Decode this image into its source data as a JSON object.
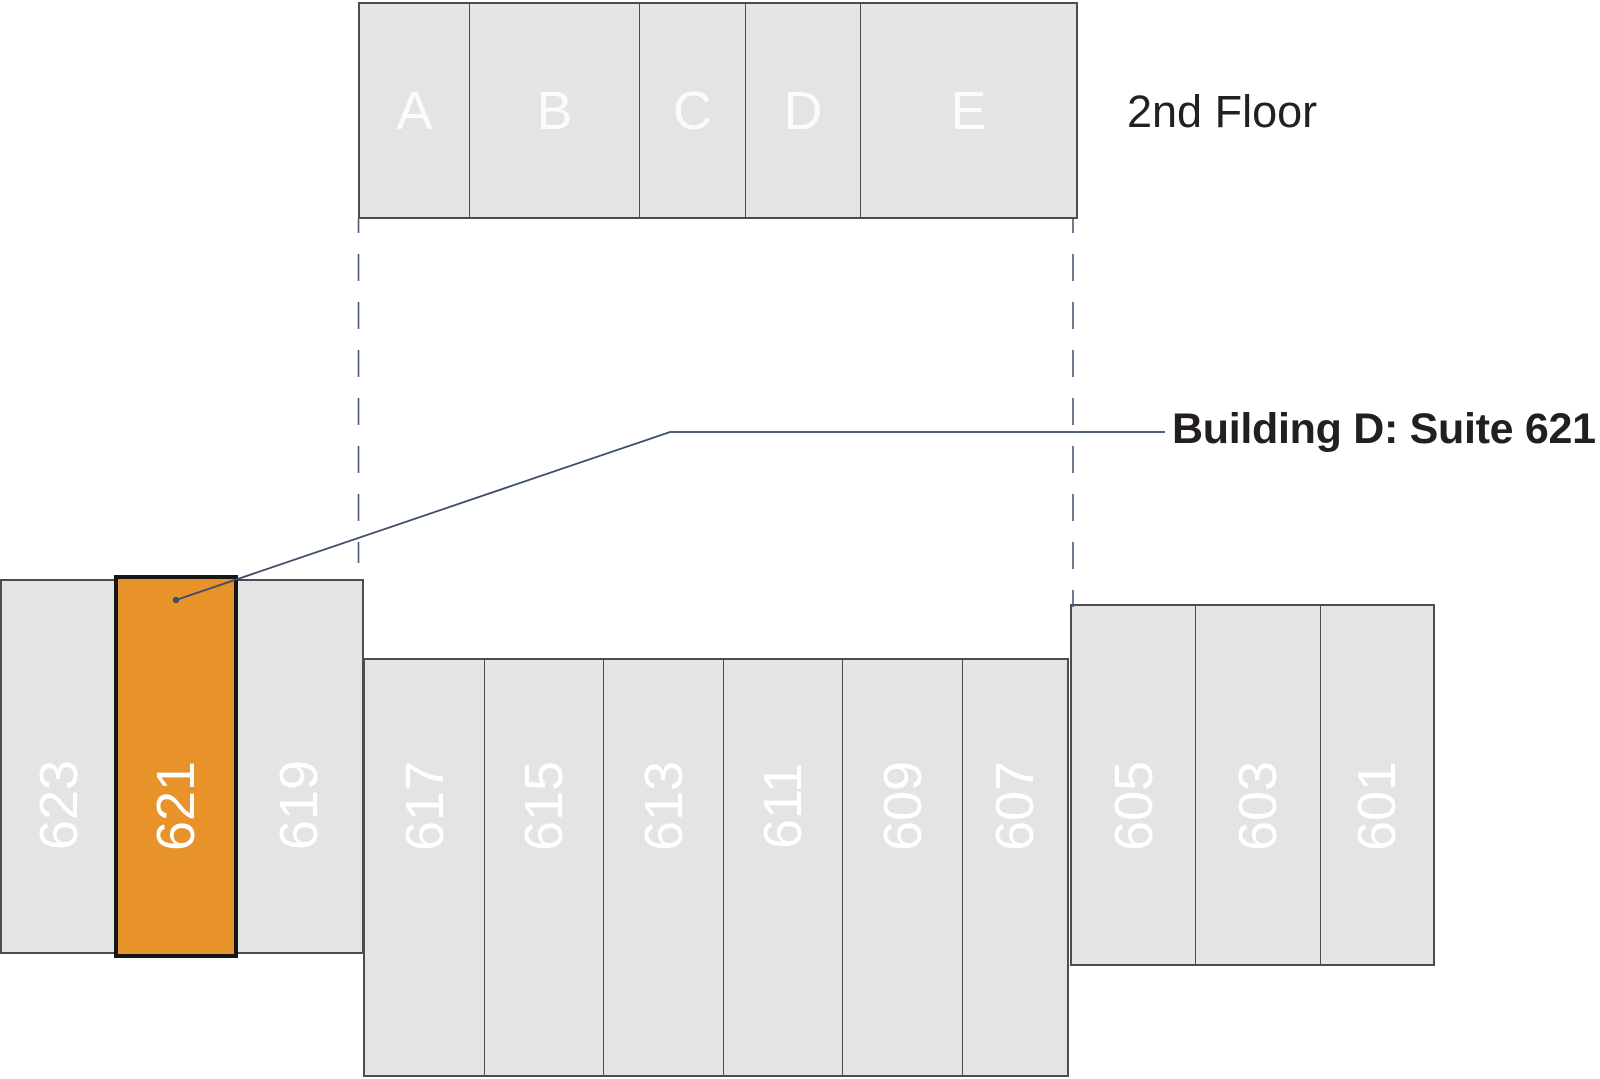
{
  "floor_label": "2nd Floor",
  "callout_label": "Building D: Suite 621",
  "upper_buildings": [
    "A",
    "B",
    "C",
    "D",
    "E"
  ],
  "suite_blocks": {
    "west": [
      "623",
      "621",
      "619"
    ],
    "center": [
      "617",
      "615",
      "613",
      "611",
      "609",
      "607"
    ],
    "east": [
      "605",
      "603",
      "601"
    ]
  },
  "highlight": {
    "suite": "621",
    "fill": "#E8922A",
    "border": "#161616"
  },
  "colors": {
    "room_fill": "#E4E4E4",
    "room_border": "#4d4d4d",
    "room_text": "#FFFFFF",
    "callout_line": "#3D4C6E",
    "dashed_line": "#4A5878",
    "label_text": "#231F20"
  }
}
